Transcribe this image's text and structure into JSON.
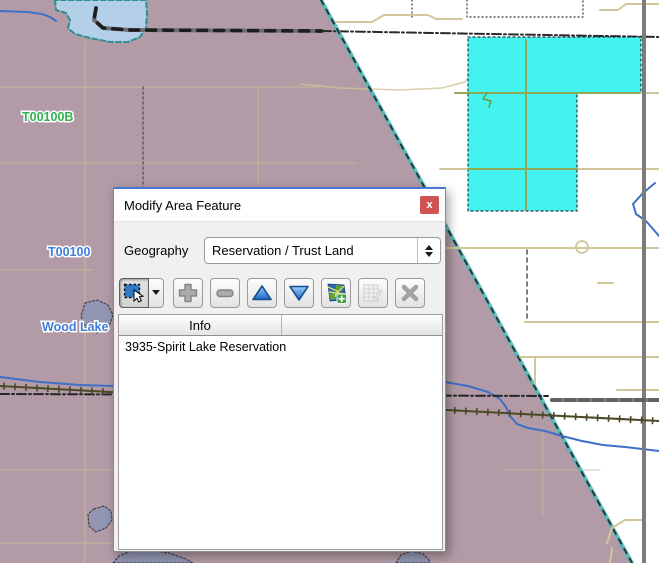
{
  "dialog": {
    "title": "Modify Area Feature",
    "close_label": "x",
    "geography_label": "Geography",
    "geography_value": "Reservation / Trust Land",
    "toolbar": {
      "icons": {
        "select_tool": "selection-arrow",
        "select_dropdown": "chevron-down",
        "add": "plus",
        "remove": "minus",
        "move_up": "triangle-up",
        "move_down": "triangle-down",
        "map": "map-with-plus",
        "attributes": "table-edit",
        "clear": "x-mark"
      }
    },
    "table": {
      "header": "Info",
      "rows": [
        "3935-Spirit Lake Reservation"
      ]
    }
  },
  "map": {
    "colors": {
      "reservation_fill": "#b29ba6",
      "selection_cyan": "#35f1ef",
      "road_tan": "#d2c79a",
      "road_gray": "#7c7c7c",
      "road_slate": "#6c6c78",
      "railroad": "#4b4926",
      "river": "#3e6fc6",
      "lake_blue": "#b4cfe8",
      "lake_gray": "#9196b4",
      "boundary_teal": "#43b7b7",
      "label_green": "#2eb34d",
      "label_blue": "#3e7ed8"
    },
    "shapes": [
      {
        "kind": "polygon",
        "pts": "0,0 321,0 632,563 0,563",
        "fill": "#b29ba6"
      },
      {
        "kind": "line",
        "pts": "0,87 318,87",
        "stroke": "#c6ba90",
        "w": 1.5,
        "op": 0.65
      },
      {
        "kind": "line",
        "pts": "85,42 85,563",
        "stroke": "#c6ba90",
        "w": 1.5,
        "op": 0.65
      },
      {
        "kind": "line",
        "pts": "0,163 356,163",
        "stroke": "#c6ba90",
        "w": 1.5,
        "op": 0.55
      },
      {
        "kind": "line",
        "pts": "258,88 258,192",
        "stroke": "#c6ba90",
        "w": 1.5,
        "op": 0.55
      },
      {
        "kind": "line",
        "pts": "0,270 92,270",
        "stroke": "#c6ba90",
        "w": 1.5,
        "op": 0.6
      },
      {
        "kind": "line",
        "pts": "0,470 113,470",
        "stroke": "#c6ba90",
        "w": 1.5,
        "op": 0.6
      },
      {
        "kind": "line",
        "pts": "0,543 112,543",
        "stroke": "#c6ba90",
        "w": 1.5,
        "op": 0.6
      },
      {
        "kind": "line",
        "pts": "300,84 340,88 400,90 442,88 465,82 472,72",
        "stroke": "#cfc399",
        "w": 1.5,
        "op": 0.8
      },
      {
        "kind": "line",
        "pts": "505,470 600,470",
        "stroke": "#c6ba90",
        "w": 1.5,
        "op": 0.5
      },
      {
        "kind": "line",
        "pts": "543,430 543,516",
        "stroke": "#c6ba90",
        "w": 1.5,
        "op": 0.5
      },
      {
        "kind": "line",
        "pts": "143,87 143,190",
        "stroke": "#4a4a4a",
        "w": 1.5,
        "dash": "2,3",
        "op": 0.8
      },
      {
        "kind": "line",
        "pts": "138,0 138,28",
        "stroke": "#333333",
        "w": 1.5,
        "dash": "2,3",
        "op": 0.8
      },
      {
        "kind": "polygon",
        "pts": "55,0 56,10 66,13 70,20 68,28 75,34 90,38 110,42 128,42 140,37 146,28 147,14 146,0",
        "fill": "#b4cfe8",
        "stroke": "#2e8f8f",
        "w": 2,
        "dash": "5,3"
      },
      {
        "kind": "line",
        "pts": "0,11 28,12 42,14 50,17 56,21",
        "stroke": "#3e6fc6",
        "w": 2
      },
      {
        "kind": "line",
        "pts": "96,8 94,20 103,28 130,30 322,31",
        "stroke": "#6c6c78",
        "w": 4
      },
      {
        "kind": "line",
        "pts": "96,8 94,20 103,28 130,30 322,31",
        "stroke": "#1d1d1d",
        "w": 3.5,
        "dash": "9,8"
      },
      {
        "kind": "line",
        "pts": "322,31 659,37",
        "stroke": "#2a2a2a",
        "w": 2,
        "dash": "9,3,2,3"
      },
      {
        "kind": "line",
        "pts": "321,0 632,563",
        "stroke": "#43b7b7",
        "w": 4,
        "op": 0.85
      },
      {
        "kind": "line",
        "pts": "321,0 632,563",
        "stroke": "#2c2c2c",
        "w": 1.8,
        "dash": "5,6"
      },
      {
        "kind": "polygon",
        "pts": "468,37 641,37 641,93 577,93 577,211 468,211",
        "fill": "#35f1ef",
        "op": 0.92,
        "stroke": "#222222",
        "w": 1.2,
        "dash": "2,3"
      },
      {
        "kind": "line",
        "pts": "467,0 467,17 583,17 583,0",
        "stroke": "#333333",
        "w": 1.2,
        "dash": "1,3"
      },
      {
        "kind": "line",
        "pts": "412,0 412,17",
        "stroke": "#333333",
        "w": 1.2,
        "dash": "1,3"
      },
      {
        "kind": "line",
        "pts": "336,22 372,22 384,15 428,15 436,19 462,19",
        "stroke": "#d2c79a",
        "w": 2
      },
      {
        "kind": "line",
        "pts": "600,10 618,10 626,4 659,4",
        "stroke": "#d2c79a",
        "w": 2
      },
      {
        "kind": "line",
        "pts": "440,169 659,169",
        "stroke": "#d2c79a",
        "w": 2
      },
      {
        "kind": "line",
        "pts": "468,169 577,169",
        "stroke": "#8fa852",
        "w": 2
      },
      {
        "kind": "line",
        "pts": "428,248 659,248",
        "stroke": "#d2c79a",
        "w": 2
      },
      {
        "kind": "line",
        "pts": "525,322 659,322",
        "stroke": "#d2c79a",
        "w": 2
      },
      {
        "kind": "line",
        "pts": "520,357 659,357",
        "stroke": "#d2c79a",
        "w": 2
      },
      {
        "kind": "line",
        "pts": "535,357 535,384",
        "stroke": "#d2c79a",
        "w": 2
      },
      {
        "kind": "line",
        "pts": "617,390 659,390",
        "stroke": "#d2c79a",
        "w": 2
      },
      {
        "kind": "line",
        "pts": "598,283 613,283",
        "stroke": "#d2c79a",
        "w": 2
      },
      {
        "kind": "circle",
        "cx": 582,
        "cy": 247,
        "r": 6,
        "stroke": "#d2c79a",
        "w": 1.8
      },
      {
        "kind": "line",
        "pts": "455,93 641,93",
        "stroke": "#8fa852",
        "w": 2
      },
      {
        "kind": "line",
        "pts": "641,93 659,93",
        "stroke": "#d2c79a",
        "w": 2
      },
      {
        "kind": "line",
        "pts": "526,40 526,210",
        "stroke": "#8fa852",
        "w": 2
      },
      {
        "kind": "line",
        "pts": "487,93 483,99 491,101 489,107",
        "stroke": "#6f9a3f",
        "w": 1.5
      },
      {
        "kind": "line",
        "pts": "607,543 612,528 625,520 645,520",
        "stroke": "#d2c79a",
        "w": 2
      },
      {
        "kind": "line",
        "pts": "610,563 612,548",
        "stroke": "#d2c79a",
        "w": 2
      },
      {
        "kind": "line",
        "pts": "527,250 527,322",
        "stroke": "#333333",
        "w": 1.3,
        "dash": "4,4"
      },
      {
        "kind": "line",
        "pts": "0,377 40,382 80,385 114,386",
        "stroke": "#3e6fc6",
        "w": 2
      },
      {
        "kind": "line",
        "pts": "445,382 468,386 488,392 500,399 506,407 510,416 517,424 528,428 545,431 562,436 582,441 603,445 625,447 659,451",
        "stroke": "#3e6fc6",
        "w": 2
      },
      {
        "kind": "line",
        "pts": "655,183 643,193 633,204 636,214 646,221 653,229 659,236",
        "stroke": "#3e6fc6",
        "w": 2
      },
      {
        "kind": "line",
        "pts": "644,0 644,563",
        "stroke": "#7c7c7c",
        "w": 4
      },
      {
        "kind": "line",
        "pts": "552,400 659,400",
        "stroke": "#7c7c7c",
        "w": 4
      },
      {
        "kind": "line",
        "pts": "552,400 659,400",
        "stroke": "#4e4e4e",
        "w": 4,
        "dash": "8,6",
        "op": 0.6
      },
      {
        "kind": "line",
        "pts": "0,394 548,396",
        "stroke": "#262626",
        "w": 2,
        "dash": "9,3,2,3"
      },
      {
        "kind": "railroad",
        "pts": "0,386 330,404 659,421",
        "stroke": "#4b4926",
        "w": 2,
        "tick": 7,
        "step": 11
      },
      {
        "kind": "polygon",
        "pts": "85,303 97,300 108,305 113,315 109,327 97,333 86,328 81,316",
        "fill": "#9196b4",
        "stroke": "#3f3f4a",
        "w": 1.2,
        "dash": "2,2",
        "op": 0.95
      },
      {
        "kind": "polygon",
        "pts": "94,509 104,506 111,511 112,520 106,528 96,532 89,526 88,514",
        "fill": "#9196b4",
        "stroke": "#3f3f4a",
        "w": 1.2,
        "dash": "2,2",
        "op": 0.95
      },
      {
        "kind": "polygon",
        "pts": "113,563 119,556 131,551 150,550 169,553 186,559 193,563",
        "fill": "#9196b4",
        "stroke": "#3f3f4a",
        "w": 1.2,
        "dash": "2,2",
        "op": 0.95
      },
      {
        "kind": "polygon",
        "pts": "396,563 401,555 412,551 423,554 429,560 430,563",
        "fill": "#9196b4",
        "stroke": "#3f3f4a",
        "w": 1.2,
        "dash": "2,2",
        "op": 0.95
      },
      {
        "kind": "text",
        "text": "T00100B",
        "x": 22,
        "y": 121,
        "fill": "#2eb34d",
        "size": 12.5,
        "name": "map-label-t00100b"
      },
      {
        "kind": "text",
        "text": "T00100",
        "x": 48,
        "y": 256,
        "fill": "#3e7ed8",
        "size": 12.5,
        "name": "map-label-t00100"
      },
      {
        "kind": "text",
        "text": "Wood Lake",
        "x": 42,
        "y": 331,
        "fill": "#3e7ed8",
        "size": 12.5,
        "name": "map-label-wood-lake"
      }
    ]
  }
}
